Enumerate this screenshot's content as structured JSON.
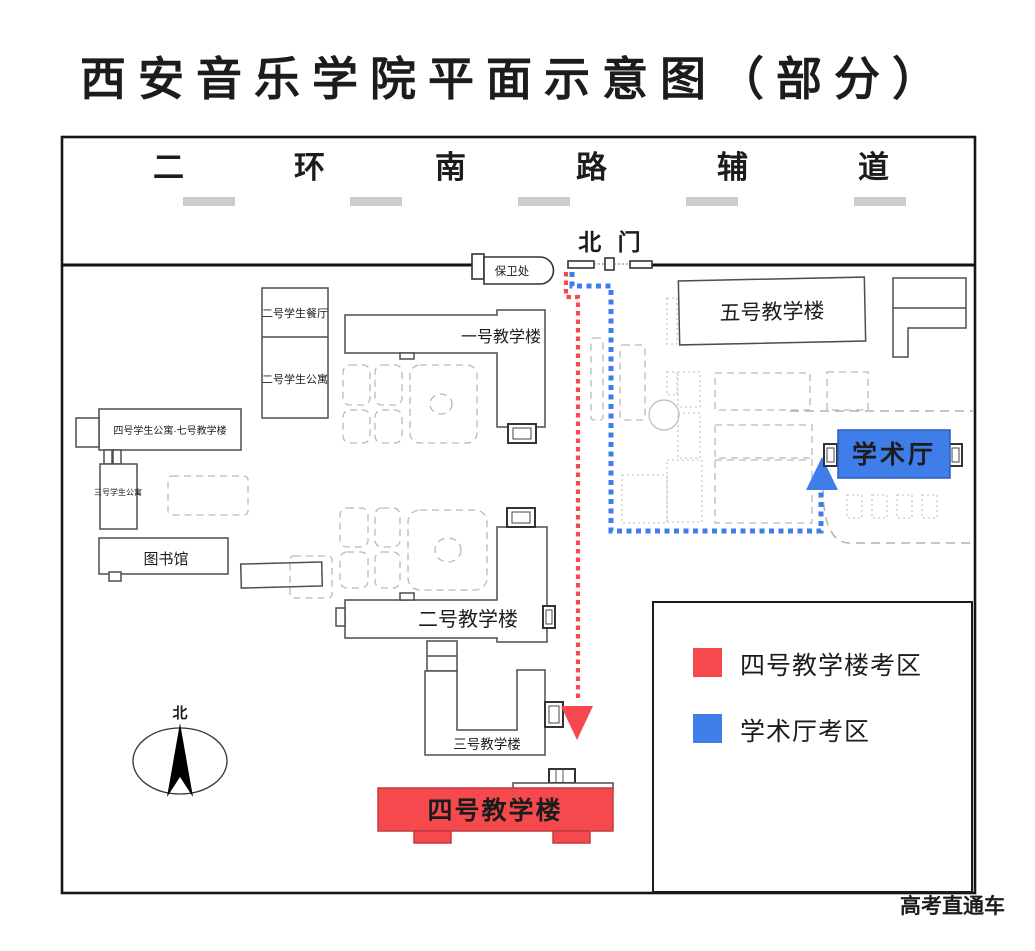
{
  "title": "西安音乐学院平面示意图（部分）",
  "road_label": "二环南路辅道",
  "north_gate_label": "北 门",
  "compass_label": "北",
  "watermark": "高考直通车",
  "buildings": {
    "security_office": "保卫处",
    "student_cafeteria_2": "二号学生餐厅",
    "student_apartment_2": "二号学生公寓",
    "teaching_building_1": "一号教学楼",
    "teaching_building_5": "五号教学楼",
    "student_apartment_4_teaching_7": "四号学生公寓·七号教学楼",
    "student_apartment_3": "三号学生公寓",
    "library": "图书馆",
    "teaching_building_2": "二号教学楼",
    "teaching_building_3": "三号教学楼",
    "teaching_building_4": "四号教学楼",
    "academic_hall": "学术厅"
  },
  "legend": {
    "items": [
      {
        "label": "四号教学楼考区",
        "color": "#f5494d"
      },
      {
        "label": "学术厅考区",
        "color": "#3f7de8"
      }
    ]
  },
  "colors": {
    "exam_red": "#f5494d",
    "exam_blue": "#3f7de8"
  }
}
